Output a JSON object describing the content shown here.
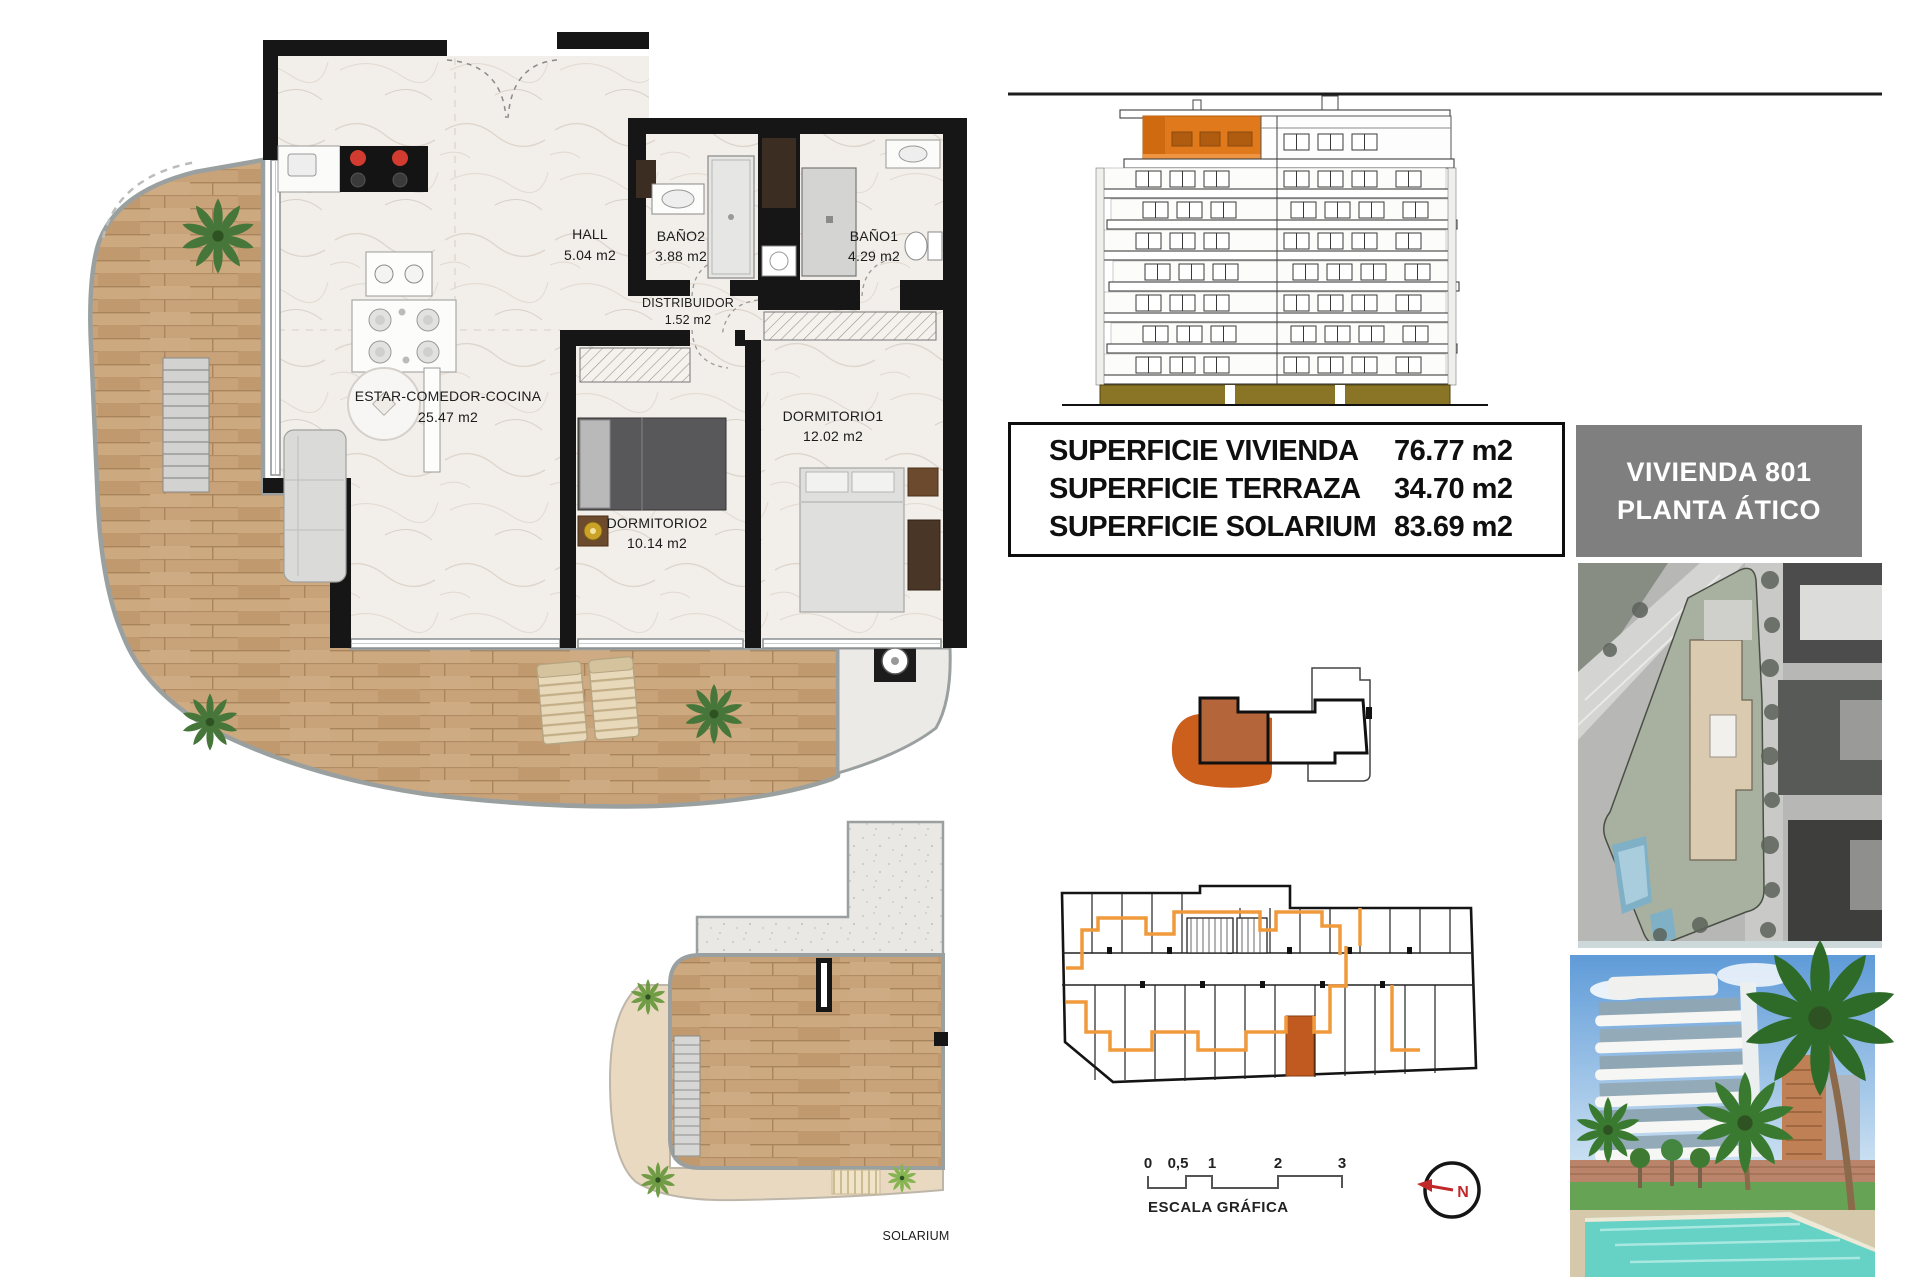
{
  "floorplan": {
    "rooms": [
      {
        "name": "HALL",
        "area": "5.04 m2"
      },
      {
        "name": "BAÑO2",
        "area": "3.88 m2"
      },
      {
        "name": "BAÑO1",
        "area": "4.29 m2"
      },
      {
        "name": "DISTRIBUIDOR",
        "area": "1.52 m2"
      },
      {
        "name": "ESTAR-COMEDOR-COCINA",
        "area": "25.47 m2"
      },
      {
        "name": "DORMITORIO2",
        "area": "10.14 m2"
      },
      {
        "name": "DORMITORIO1",
        "area": "12.02 m2"
      }
    ],
    "solarium_label": "SOLARIUM"
  },
  "summary_table": {
    "rows": [
      {
        "label": "SUPERFICIE VIVIENDA",
        "value": "76.77 m2"
      },
      {
        "label": "SUPERFICIE TERRAZA",
        "value": "34.70 m2"
      },
      {
        "label": "SUPERFICIE SOLARIUM",
        "value": "83.69 m2"
      }
    ]
  },
  "unit_badge": {
    "line1": "VIVIENDA 801",
    "line2": "PLANTA ÁTICO"
  },
  "scale_bar": {
    "ticks": [
      "0",
      "0,5",
      "1",
      "2",
      "3"
    ],
    "label": "ESCALA GRÁFICA"
  },
  "compass": {
    "label": "N"
  },
  "colors": {
    "highlight_orange": "#E0791C",
    "unit_brown": "#B4653A",
    "route_orange": "#F09A3C",
    "badge_gray": "#7F7F7F",
    "base_olive": "#8A7426",
    "north_red": "#C0282A",
    "terrace_wood": "#C8A37A"
  }
}
